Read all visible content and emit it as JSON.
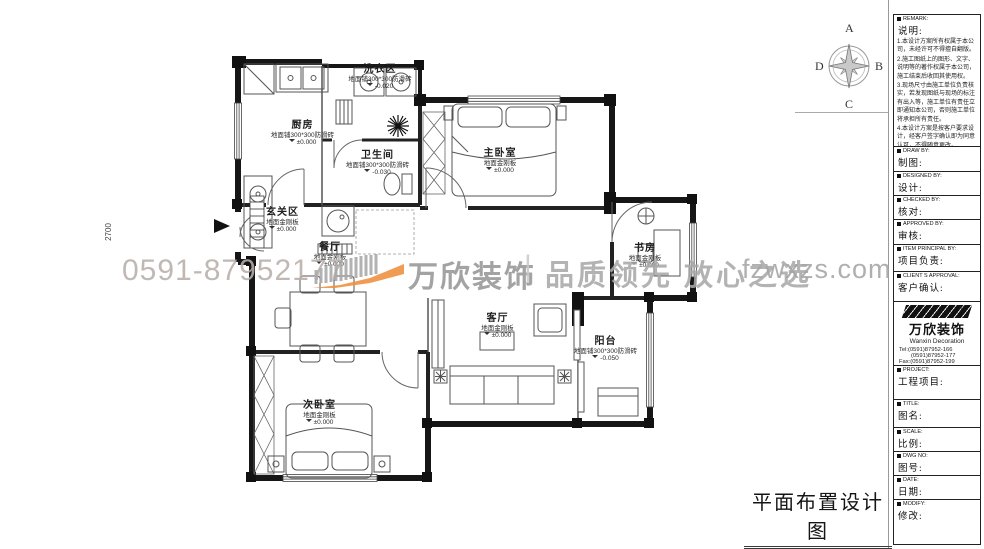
{
  "drawing_title": "平面布置设计图",
  "dimension_label": "2700",
  "watermark": {
    "phone": "0591-87952177",
    "logo_text": "万欣装饰",
    "separator": "|",
    "slogan": "品质领先 放心之选",
    "website": "fzwxzs.com",
    "accent_color": "#ef8f3e",
    "gray_color": "#a9a9a9"
  },
  "compass": {
    "north": "A",
    "east": "B",
    "south": "C",
    "west": "D"
  },
  "rooms": [
    {
      "name": "洗衣区",
      "floor": "地面铺300*300防滑砖",
      "level": "-0.020"
    },
    {
      "name": "厨房",
      "floor": "地面铺300*300防滑砖",
      "level": "±0.000"
    },
    {
      "name": "卫生间",
      "floor": "地面铺300*300防滑砖",
      "level": "-0.030"
    },
    {
      "name": "主卧室",
      "floor": "地面金刚板",
      "level": "±0.000"
    },
    {
      "name": "玄关区",
      "floor": "地面金刚板",
      "level": "±0.000"
    },
    {
      "name": "餐厅",
      "floor": "地面金刚板",
      "level": "±0.000"
    },
    {
      "name": "书房",
      "floor": "地面金刚板",
      "level": "±0.000"
    },
    {
      "name": "客厅",
      "floor": "地面金刚板",
      "level": "±0.000"
    },
    {
      "name": "阳台",
      "floor": "地面铺300*300防滑砖",
      "level": "-0.050"
    },
    {
      "name": "次卧室",
      "floor": "地面金刚板",
      "level": "±0.000"
    }
  ],
  "title_block": {
    "sections": [
      {
        "en": "REMARK:",
        "zh": "说明:"
      },
      {
        "en": "DRAW BY:",
        "zh": "制图:"
      },
      {
        "en": "DESIGNED BY:",
        "zh": "设计:"
      },
      {
        "en": "CHECKED BY:",
        "zh": "核对:"
      },
      {
        "en": "APPROVED BY:",
        "zh": "审核:"
      },
      {
        "en": "ITEM PRINCIPAL BY:",
        "zh": "项目负责:"
      },
      {
        "en": "CLIENT S APPROVAL:",
        "zh": "客户确认:"
      },
      {
        "en": "PROJECT:",
        "zh": "工程项目:"
      },
      {
        "en": "TITLE:",
        "zh": "图名:"
      },
      {
        "en": "SCALE:",
        "zh": "比例:"
      },
      {
        "en": "DWG NO:",
        "zh": "图号:"
      },
      {
        "en": "DATE:",
        "zh": "日期:"
      },
      {
        "en": "MODIFY:",
        "zh": "修改:"
      }
    ],
    "notes": {
      "n1": "1.本设计方案所有权属于本公司，未经许可不得擅自翻版。",
      "n2": "2.施工图纸上的图形、文字、说明等的著作权属于本公司，施工结束后收回其使用权。",
      "n3": "3.现场尺寸由施工单位负责核实，若发现图纸与现场的标注有出入等，施工单位有责任立即通知本公司，否则施工单位将承担所有责任。",
      "n4": "4.本设计方案是按客户要求设计，经客户签字确认即为同意认可，不得随意更改。"
    },
    "company": {
      "reg_mark": "®",
      "logo_name": "万欣装饰",
      "logo_en": "Wanxin Decoration",
      "tel1": "Tel:(0591)87952-166",
      "tel2": "(0591)87952-177",
      "fax": "Fax:(0591)87952-199",
      "web": "Web:WWW.fzwxzs.com"
    }
  }
}
